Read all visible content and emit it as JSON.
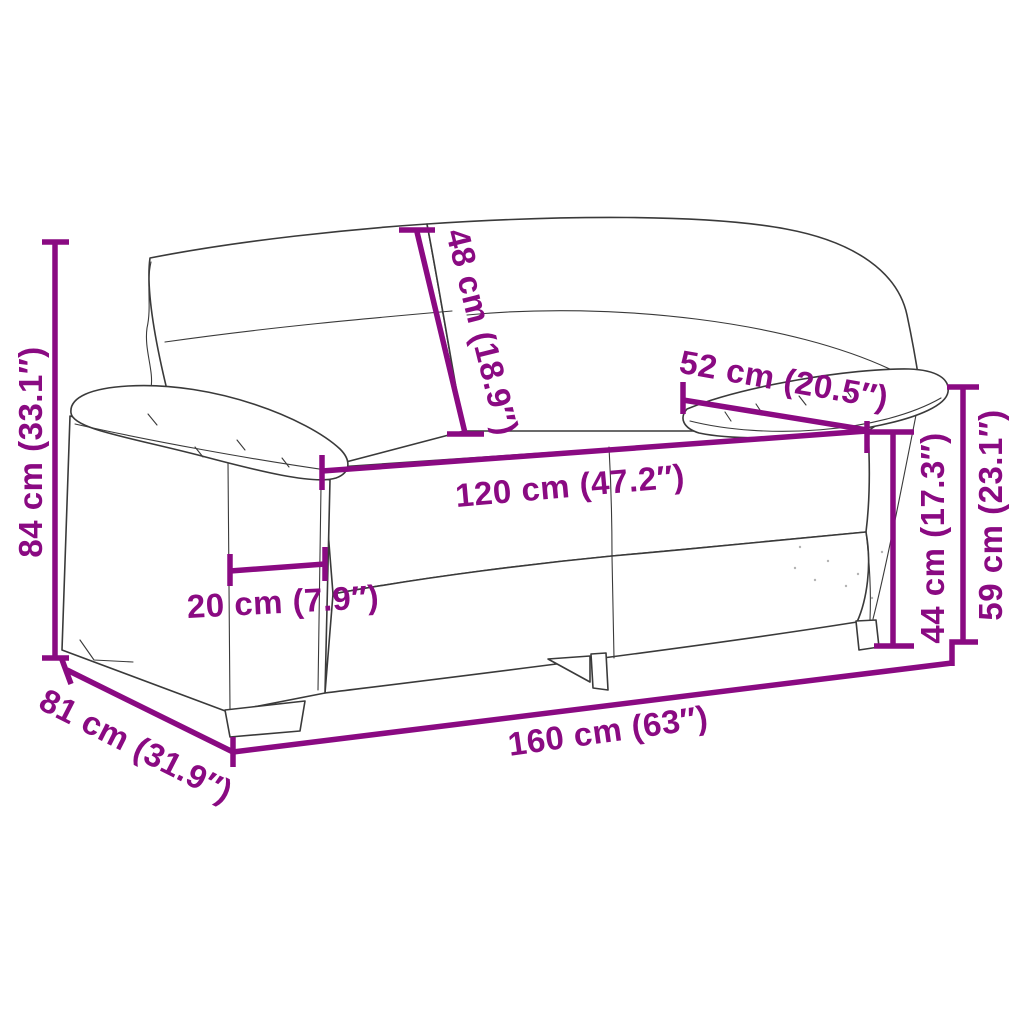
{
  "diagram": {
    "subject": "two-seater sofa line drawing with measurements",
    "background_color": "#ffffff",
    "sketch_color": "#3a3a3a",
    "dimension_color": "#8A0A82",
    "dimensions": {
      "overall_height": {
        "label": "84 cm (33.1″)",
        "cm": 84,
        "inches": 33.1
      },
      "backrest_height": {
        "label": "48 cm (18.9″)",
        "cm": 48,
        "inches": 18.9
      },
      "armrest_length": {
        "label": "52 cm (20.5″)",
        "cm": 52,
        "inches": 20.5
      },
      "seat_width": {
        "label": "120 cm (47.2″)",
        "cm": 120,
        "inches": 47.2
      },
      "armrest_width": {
        "label": "20 cm (7.9″)",
        "cm": 20,
        "inches": 7.9
      },
      "seat_height": {
        "label": "44 cm (17.3″)",
        "cm": 44,
        "inches": 17.3
      },
      "armrest_height": {
        "label": "59 cm (23.1″)",
        "cm": 59,
        "inches": 23.1
      },
      "overall_width": {
        "label": "160 cm (63″)",
        "cm": 160,
        "inches": 63
      },
      "overall_depth": {
        "label": "81 cm (31.9″)",
        "cm": 81,
        "inches": 31.9
      }
    }
  }
}
